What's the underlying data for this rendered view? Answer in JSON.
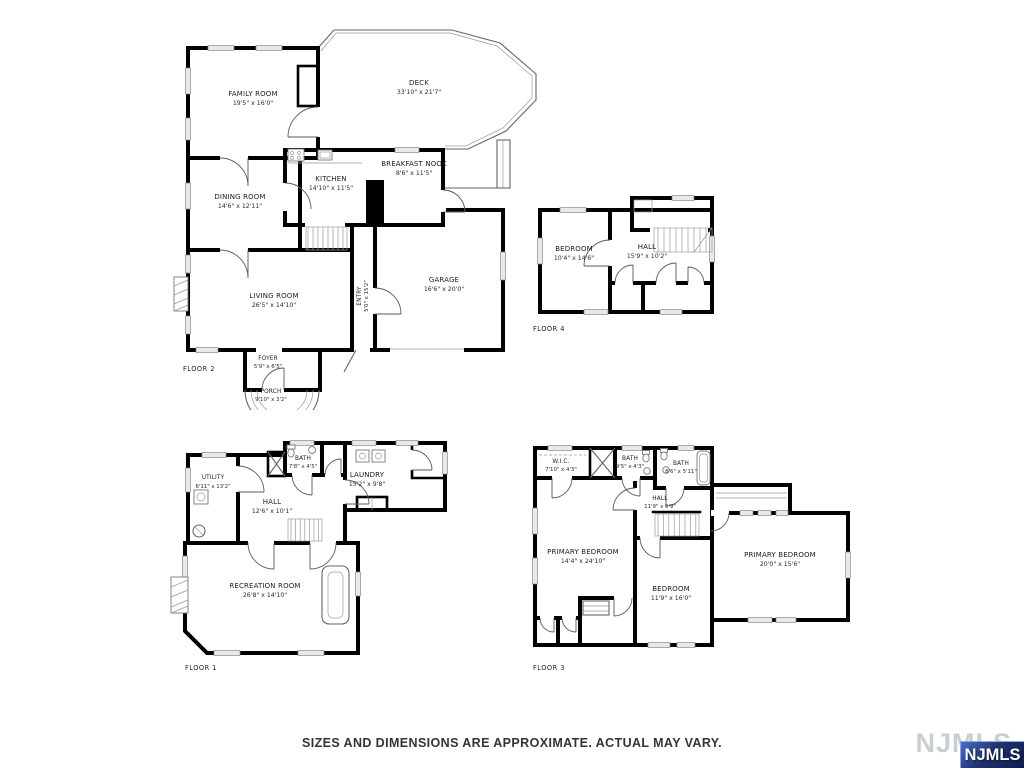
{
  "page": {
    "disclaimer": "SIZES AND DIMENSIONS ARE APPROXIMATE. ACTUAL MAY VARY.",
    "watermark": "NJMLS",
    "logo_text": "NJMLS",
    "colors": {
      "wall": "#000000",
      "window_fill": "#e9e9e9",
      "thin_line": "#666666",
      "text": "#1c1c1c",
      "logo_blue_dark": "#0d1d50",
      "logo_blue_light": "#4a6fc8",
      "watermark_gray": "#c9ced3"
    }
  },
  "floors": [
    {
      "id": "floor-2",
      "label": "FLOOR 2",
      "rooms": [
        {
          "name": "FAMILY ROOM",
          "dims": "19'5\" x 16'0\""
        },
        {
          "name": "DECK",
          "dims": "33'10\" x 21'7\""
        },
        {
          "name": "BREAKFAST NOOK",
          "dims": "8'6\" x 11'5\""
        },
        {
          "name": "KITCHEN",
          "dims": "14'10\" x 11'5\""
        },
        {
          "name": "DINING ROOM",
          "dims": "14'6\" x 12'11\""
        },
        {
          "name": "LIVING ROOM",
          "dims": "26'5\" x 14'10\""
        },
        {
          "name": "ENTRY",
          "dims": "5'0\" x 15'2\""
        },
        {
          "name": "GARAGE",
          "dims": "16'6\" x 20'0\""
        },
        {
          "name": "FOYER",
          "dims": "5'9\" x 6'5\""
        },
        {
          "name": "PORCH",
          "dims": "9'10\" x 3'2\""
        }
      ]
    },
    {
      "id": "floor-4",
      "label": "FLOOR 4",
      "rooms": [
        {
          "name": "BEDROOM",
          "dims": "10'4\" x 14'6\""
        },
        {
          "name": "HALL",
          "dims": "15'9\" x 10'2\""
        }
      ]
    },
    {
      "id": "floor-1",
      "label": "FLOOR 1",
      "rooms": [
        {
          "name": "UTILITY",
          "dims": "6'11\" x 13'2\""
        },
        {
          "name": "BATH",
          "dims": "7'8\" x 4'5\""
        },
        {
          "name": "LAUNDRY",
          "dims": "15'2\" x 9'8\""
        },
        {
          "name": "HALL",
          "dims": "12'6\" x 10'1\""
        },
        {
          "name": "RECREATION ROOM",
          "dims": "26'8\" x 14'10\""
        }
      ]
    },
    {
      "id": "floor-3",
      "label": "FLOOR 3",
      "rooms": [
        {
          "name": "W.I.C.",
          "dims": "7'10\" x 4'3\""
        },
        {
          "name": "BATH",
          "dims": "9'5\" x 4'3\""
        },
        {
          "name": "BATH",
          "dims": "8'6\" x 5'11\""
        },
        {
          "name": "HALL",
          "dims": "11'9\" x 6'9\""
        },
        {
          "name": "PRIMARY BEDROOM",
          "dims": "14'4\" x 24'10\""
        },
        {
          "name": "BEDROOM",
          "dims": "11'9\" x 16'0\""
        },
        {
          "name": "PRIMARY BEDROOM",
          "dims": "20'0\" x 15'6\""
        }
      ]
    }
  ]
}
